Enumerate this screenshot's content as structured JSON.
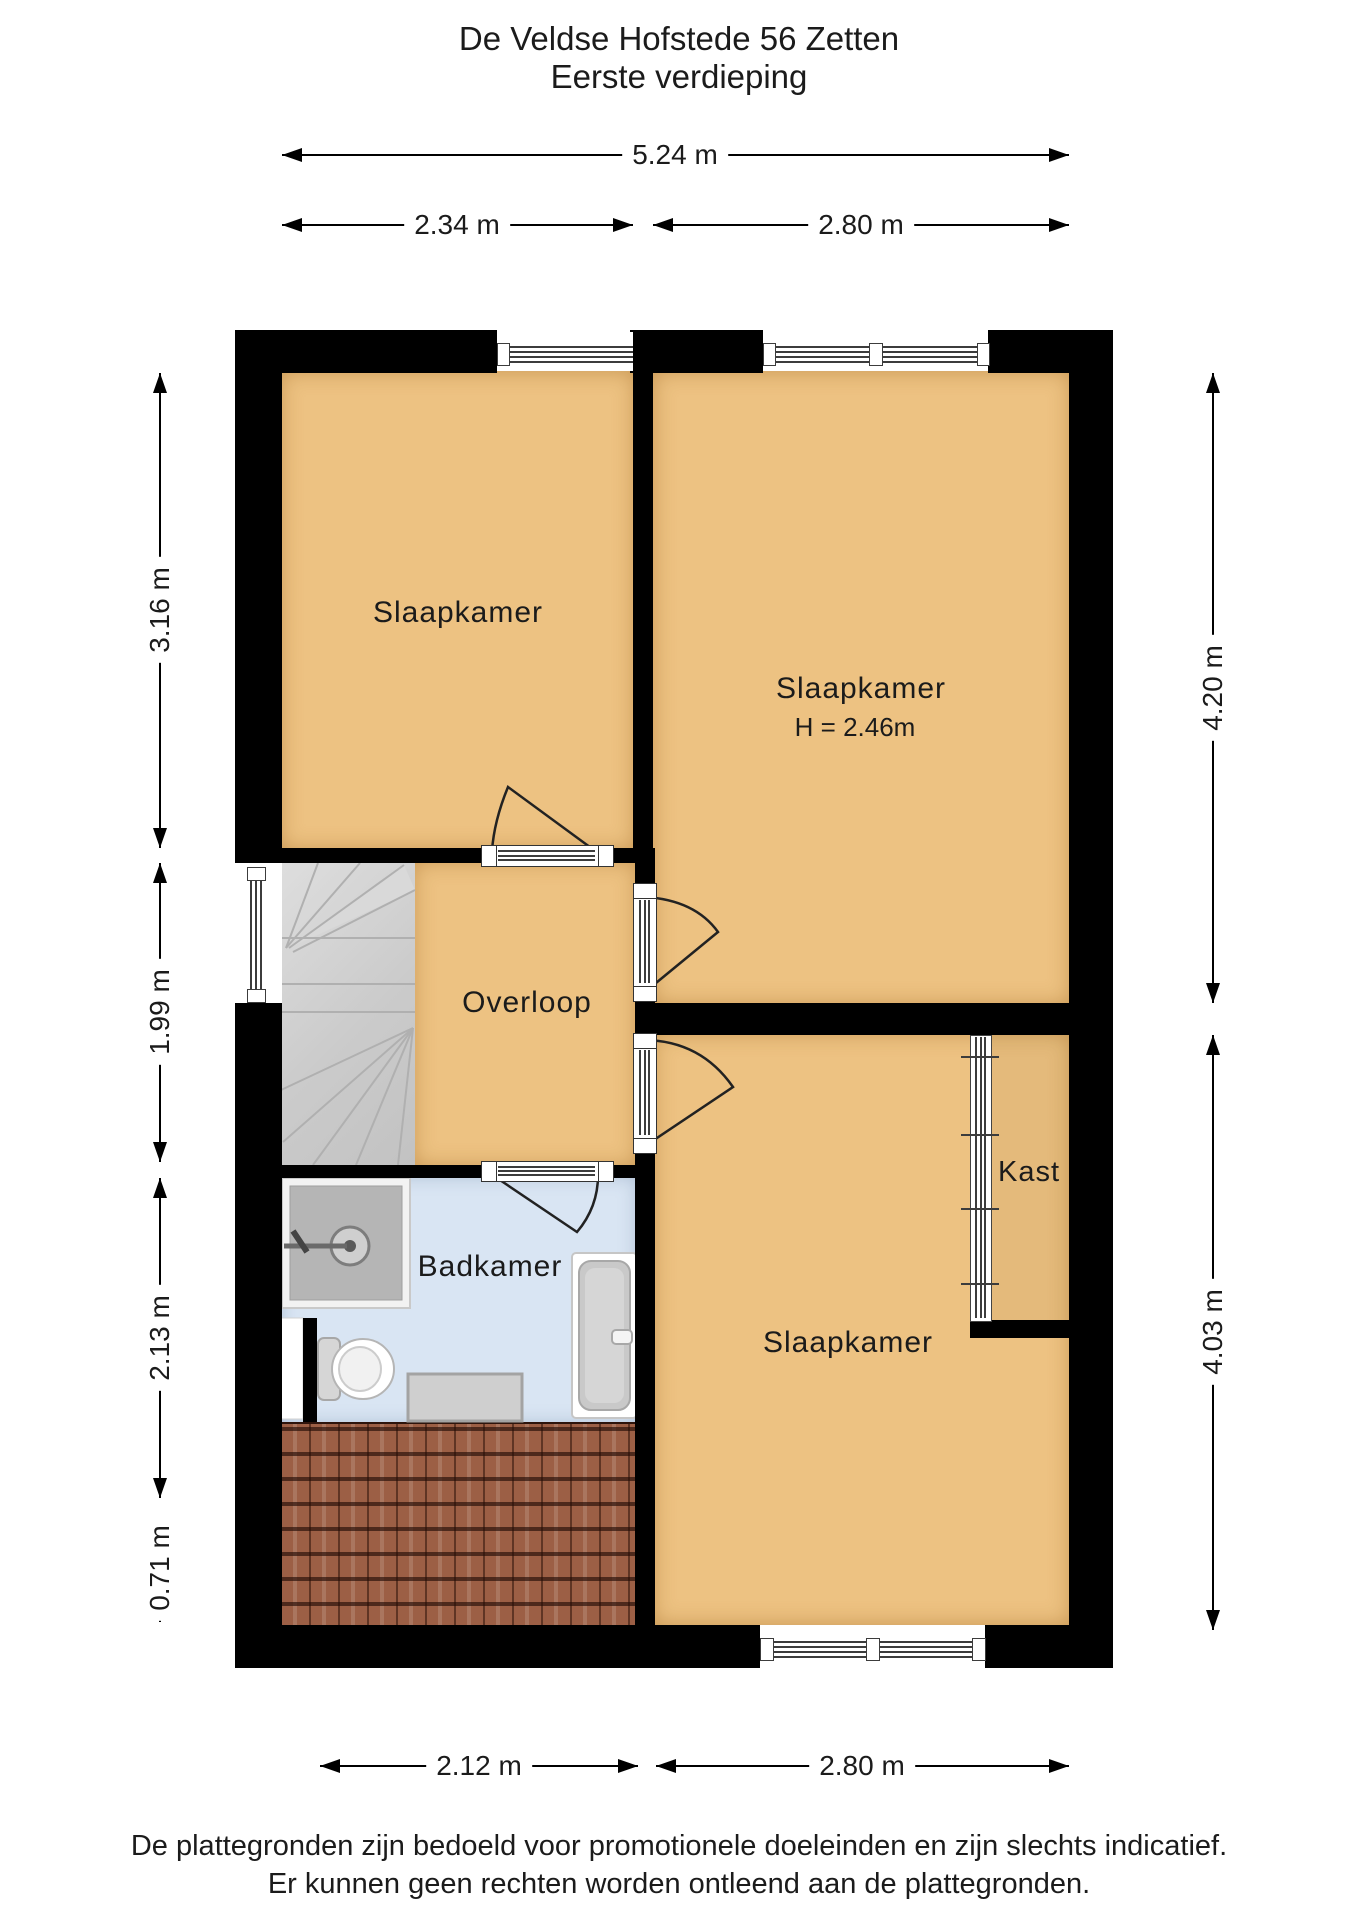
{
  "title": {
    "line1": "De Veldse Hofstede 56 Zetten",
    "line2": "Eerste verdieping"
  },
  "rooms": {
    "slaapkamer_topleft": {
      "label": "Slaapkamer"
    },
    "slaapkamer_topright": {
      "label": "Slaapkamer",
      "height_note": "H = 2.46m"
    },
    "slaapkamer_bottom": {
      "label": "Slaapkamer"
    },
    "overloop": {
      "label": "Overloop"
    },
    "badkamer": {
      "label": "Badkamer"
    },
    "kast": {
      "label": "Kast"
    }
  },
  "dimensions": {
    "top": [
      {
        "label": "5.24 m"
      },
      {
        "label": "2.34 m"
      },
      {
        "label": "2.80 m"
      }
    ],
    "left": [
      {
        "label": "3.16 m"
      },
      {
        "label": "1.99 m"
      },
      {
        "label": "2.13 m"
      },
      {
        "label": "0.71 m"
      }
    ],
    "right": [
      {
        "label": "4.20 m"
      },
      {
        "label": "4.03 m"
      }
    ],
    "bottom": [
      {
        "label": "2.12 m"
      },
      {
        "label": "2.80 m"
      }
    ]
  },
  "footer": {
    "line1": "De plattegronden zijn bedoeld voor promotionele doeleinden en zijn slechts indicatief.",
    "line2": "Er kunnen geen rechten worden ontleend aan de plattegronden."
  },
  "colors": {
    "wall": "#000000",
    "floor": "#edc282",
    "bathroom_floor": "#d9e5f3",
    "stairs": "#cccccc",
    "roof_tiles": "#9c5f45",
    "background": "#ffffff"
  }
}
